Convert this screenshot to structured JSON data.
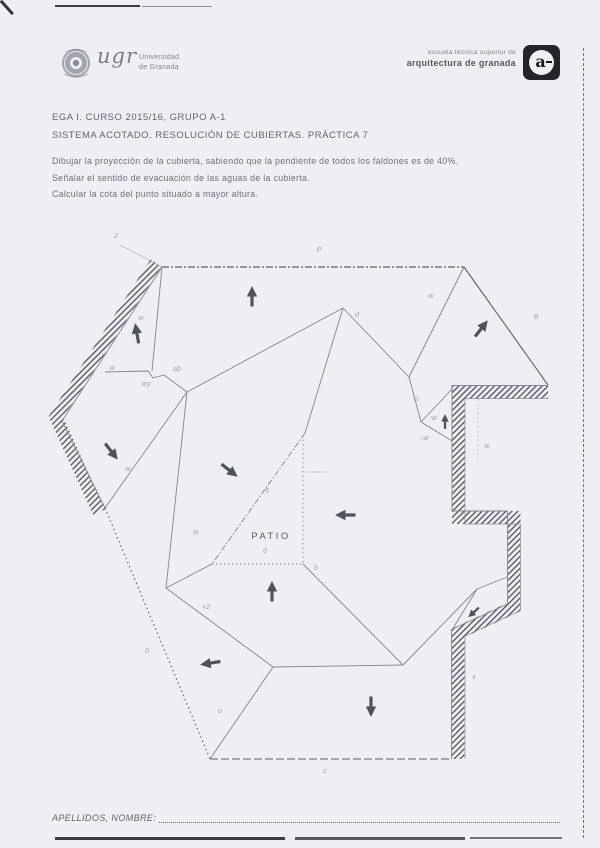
{
  "page": {
    "background": "#edeff4",
    "ink": "#82868d",
    "dark_ink": "#5c6067",
    "hatch_color": "#474b52",
    "arrow_color": "#4f545a",
    "mark_color": "#989da5"
  },
  "header": {
    "university": {
      "wordmark": "ugr",
      "name_line1": "Universidad",
      "name_line2": "de Granada"
    },
    "school": {
      "line1": "escuela técnica superior de",
      "line2": "arquitectura de granada",
      "logo_letter": "a"
    },
    "course_line": "EGA I. CURSO 2015/16, GRUPO A-1",
    "title_line": "SISTEMA ACOTADO. RESOLUCIÓN DE CUBIERTAS. PRÁCTICA 7"
  },
  "instructions": [
    "Dibujar la proyección de la cubierta, sabiendo que la pendiente de todos los faldones es de 40%.",
    "Señalar el sentido de evacuación de las aguas de la cubierta.",
    "Calcular la cota del punto situado a mayor altura."
  ],
  "footer": {
    "label": "APELLIDOS, NOMBRE:"
  },
  "drawing": {
    "patio_label": "PATIO",
    "patio_label_pos": {
      "x": 271,
      "y": 539
    },
    "walls": [
      {
        "name": "left-exterior-wall",
        "pts": "156,263 56,417 99,512",
        "w": 13
      },
      {
        "name": "right-exterior-wall",
        "pts": "548,392 458.5,392 458.5,517.5 514,517.5 514,607 458,633 458,759",
        "w": 13
      }
    ],
    "lines": [
      {
        "n": "roof-hip-line",
        "p": "162,267 152,371"
      },
      {
        "n": "roof-valley-line",
        "p": "105,372 148,371 153,378 164,375"
      },
      {
        "n": "roof-valley-line",
        "p": "164,375 187,392"
      },
      {
        "n": "roof-ridge-line",
        "p": "187,392 166,588"
      },
      {
        "n": "roof-hip-line",
        "p": "187,392 105,508"
      },
      {
        "n": "roof-ridge-line",
        "p": "187,392 343,308"
      },
      {
        "n": "roof-hip-line",
        "p": "343,308 305,433"
      },
      {
        "n": "roof-ridge-line",
        "p": "343,308 409,377"
      },
      {
        "n": "roof-hip-line",
        "p": "464,267 409,377"
      },
      {
        "n": "roof-ridge-line",
        "p": "409,377 421,422"
      },
      {
        "n": "roof-valley-line",
        "p": "421,422 453,388"
      },
      {
        "n": "roof-valley-line",
        "p": "421,422 452,441"
      },
      {
        "n": "roof-valley-line",
        "p": "166,588 212,564"
      },
      {
        "n": "roof-valley-line",
        "p": "166,588 273,667"
      },
      {
        "n": "roof-ridge-line",
        "p": "273,667 403,665"
      },
      {
        "n": "roof-hip-line",
        "p": "210,759 273,667"
      },
      {
        "n": "roof-valley-line",
        "p": "303,564 403,665"
      },
      {
        "n": "roof-ridge-line",
        "p": "403,665 477,589"
      },
      {
        "n": "roof-ridge-line",
        "p": "477,589 507,577"
      },
      {
        "n": "roof-hip-line",
        "p": "477,589 452,630"
      },
      {
        "n": "roof-eave-edge",
        "p": "464,267 548,385",
        "w": 1.1,
        "c": "#5c6067"
      },
      {
        "n": "wall-inner-edge",
        "p": "162,267 62,421 105,508"
      },
      {
        "n": "wall-inner-edge",
        "p": "548,385.5 452,385.5 452,511 507.5,511 507.5,604 451.5,629.5 451.5,759"
      },
      {
        "n": "wall-outer-edge",
        "p": "548,398.5 465,398.5 465,524 520.5,524 520.5,610.5 465,636 465,759",
        "o": 0.7
      },
      {
        "n": "eave-line-top",
        "p": "162,267 464,267",
        "d": "7,2,2,2",
        "w": 1.2,
        "c": "#5c6067"
      },
      {
        "n": "eave-line-bottom",
        "p": "210,759 452,759",
        "d": "8,3",
        "w": 1.1,
        "c": "#5c6067"
      },
      {
        "n": "eave-line-left",
        "p": "105,508 210,759",
        "d": "1.5,3",
        "w": 1.1,
        "c": "#5c6067"
      },
      {
        "n": "patio-edge",
        "p": "305,433 212,564",
        "d": "6,2,1.5,2",
        "w": 0.9
      },
      {
        "n": "patio-edge",
        "p": "212,564 303,564",
        "d": "1.5,2.5",
        "w": 1
      },
      {
        "n": "patio-edge",
        "p": "303,435 303,564",
        "d": "1.5,3",
        "w": 0.9
      },
      {
        "n": "construction-line",
        "p": "120,245 162,267",
        "w": 0.7,
        "o": 0.8,
        "c": "#9aa0a7"
      },
      {
        "n": "construction-line",
        "p": "478,399 478,460",
        "d": "2,2.5",
        "w": 0.7,
        "o": 0.8,
        "c": "#9aa0a7"
      },
      {
        "n": "construction-line",
        "p": "306,472 326,472",
        "w": 0.7,
        "o": 0.7,
        "c": "#9aa0a7"
      }
    ],
    "arrows": [
      {
        "x": 252,
        "y": 297,
        "a": 0
      },
      {
        "x": 137,
        "y": 334,
        "a": -10
      },
      {
        "x": 481,
        "y": 329,
        "a": 38
      },
      {
        "x": 111,
        "y": 451,
        "a": 142
      },
      {
        "x": 229,
        "y": 470,
        "a": 128
      },
      {
        "x": 346,
        "y": 515,
        "a": -90
      },
      {
        "x": 272,
        "y": 592,
        "a": 0
      },
      {
        "x": 211,
        "y": 663,
        "a": -99
      },
      {
        "x": 371,
        "y": 706,
        "a": 180
      },
      {
        "x": 445,
        "y": 422,
        "a": 0,
        "s": 0.72
      },
      {
        "x": 474,
        "y": 612,
        "a": -132,
        "s": 0.7
      }
    ],
    "marks": [
      {
        "x": 116,
        "y": 238,
        "t": "2"
      },
      {
        "x": 319,
        "y": 252,
        "t": "P"
      },
      {
        "x": 357,
        "y": 317,
        "t": "d"
      },
      {
        "x": 431,
        "y": 298,
        "t": "w"
      },
      {
        "x": 536,
        "y": 319,
        "t": "B"
      },
      {
        "x": 141,
        "y": 320,
        "t": "w"
      },
      {
        "x": 112,
        "y": 370,
        "t": "w"
      },
      {
        "x": 146,
        "y": 386,
        "t": "wy"
      },
      {
        "x": 177,
        "y": 371,
        "t": "ab"
      },
      {
        "x": 128,
        "y": 471,
        "t": "w"
      },
      {
        "x": 196,
        "y": 535,
        "t": "R"
      },
      {
        "x": 267,
        "y": 493,
        "t": "5"
      },
      {
        "x": 265,
        "y": 553,
        "t": "6"
      },
      {
        "x": 316,
        "y": 570,
        "t": "h"
      },
      {
        "x": 206,
        "y": 609,
        "t": "+2"
      },
      {
        "x": 147,
        "y": 653,
        "t": "0"
      },
      {
        "x": 220,
        "y": 713,
        "t": "o"
      },
      {
        "x": 325,
        "y": 773,
        "t": "c"
      },
      {
        "x": 416,
        "y": 401,
        "t": "½"
      },
      {
        "x": 434,
        "y": 420,
        "t": "w"
      },
      {
        "x": 424,
        "y": 440,
        "t": "↓w"
      },
      {
        "x": 487,
        "y": 448,
        "t": "w"
      },
      {
        "x": 474,
        "y": 679,
        "t": "x"
      }
    ]
  }
}
